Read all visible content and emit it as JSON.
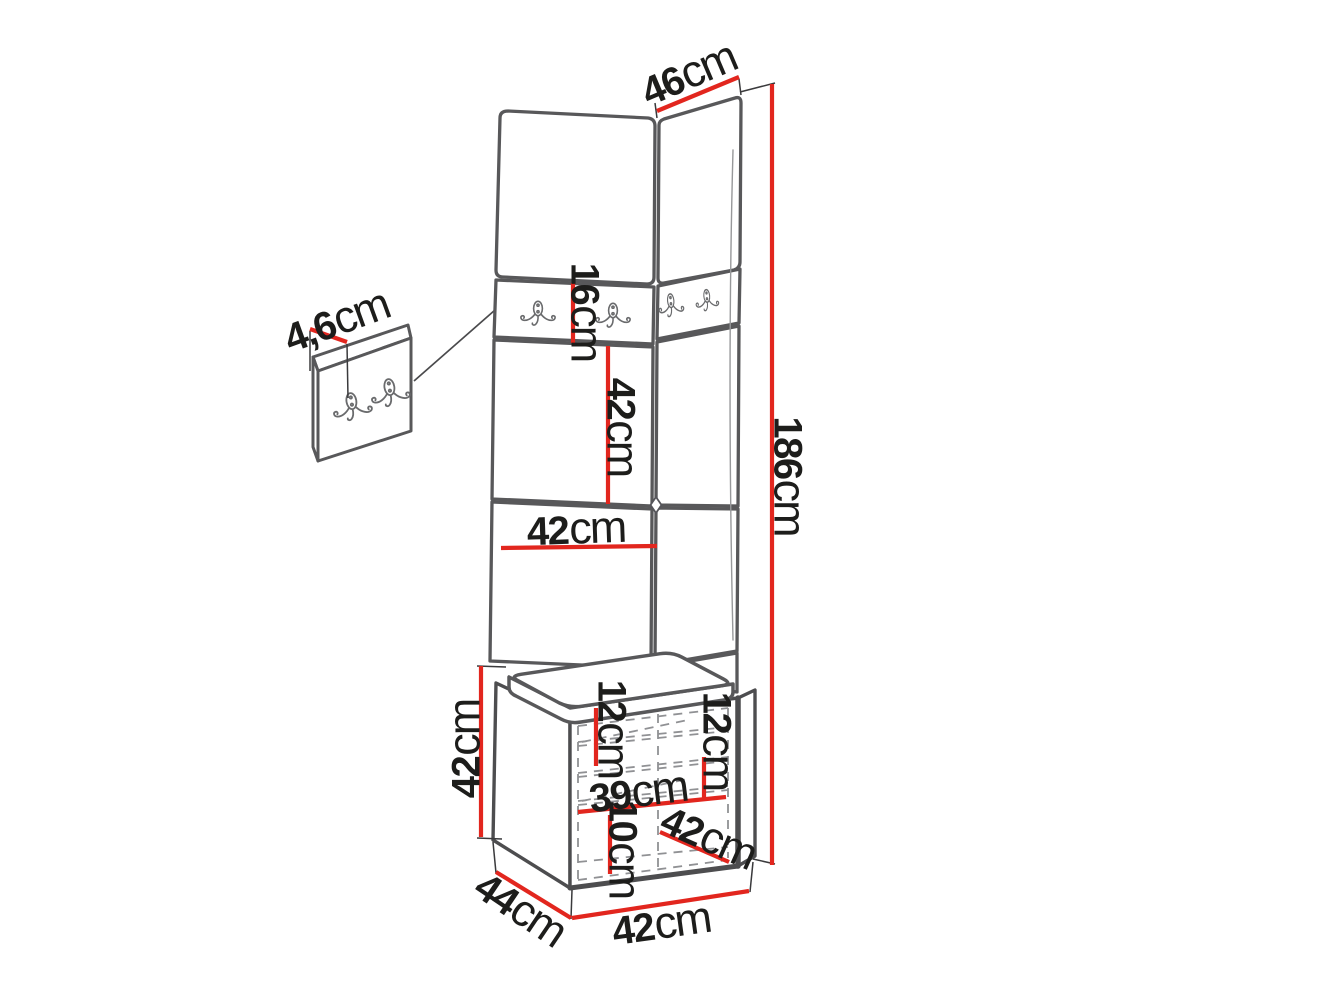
{
  "figure": {
    "type": "furniture-dimension-diagram",
    "subject": "hallway corner panel set with coat hooks, upholstered wall tiles, seat cushion and shoe cabinet"
  },
  "dimensions": {
    "panel_top_depth": {
      "value": "46",
      "unit": "cm"
    },
    "total_height": {
      "value": "186",
      "unit": "cm"
    },
    "tile_thickness": {
      "value": "4,6",
      "unit": "cm"
    },
    "hook_tile_height": {
      "value": "16",
      "unit": "cm"
    },
    "tile_height": {
      "value": "42",
      "unit": "cm"
    },
    "tile_width": {
      "value": "42",
      "unit": "cm"
    },
    "cabinet_height": {
      "value": "42",
      "unit": "cm"
    },
    "shelf_gap_left": {
      "value": "12",
      "unit": "cm"
    },
    "shelf_gap_right": {
      "value": "12",
      "unit": "cm"
    },
    "interior_width": {
      "value": "39",
      "unit": "cm"
    },
    "bottom_gap": {
      "value": "10",
      "unit": "cm"
    },
    "door_width": {
      "value": "42",
      "unit": "cm"
    },
    "cabinet_depth": {
      "value": "44",
      "unit": "cm"
    },
    "cabinet_width": {
      "value": "42",
      "unit": "cm"
    }
  },
  "icons": {
    "coat_hook": "double-coat-hook"
  },
  "colors": {
    "dimension_red": "#e2261e",
    "outline_gray": "#58585a",
    "cabinet_gray": "#4d4d4f",
    "dash_gray": "#909194",
    "thin_black": "#3a3a3c",
    "text": "#1d1d1b",
    "background": "#ffffff"
  }
}
